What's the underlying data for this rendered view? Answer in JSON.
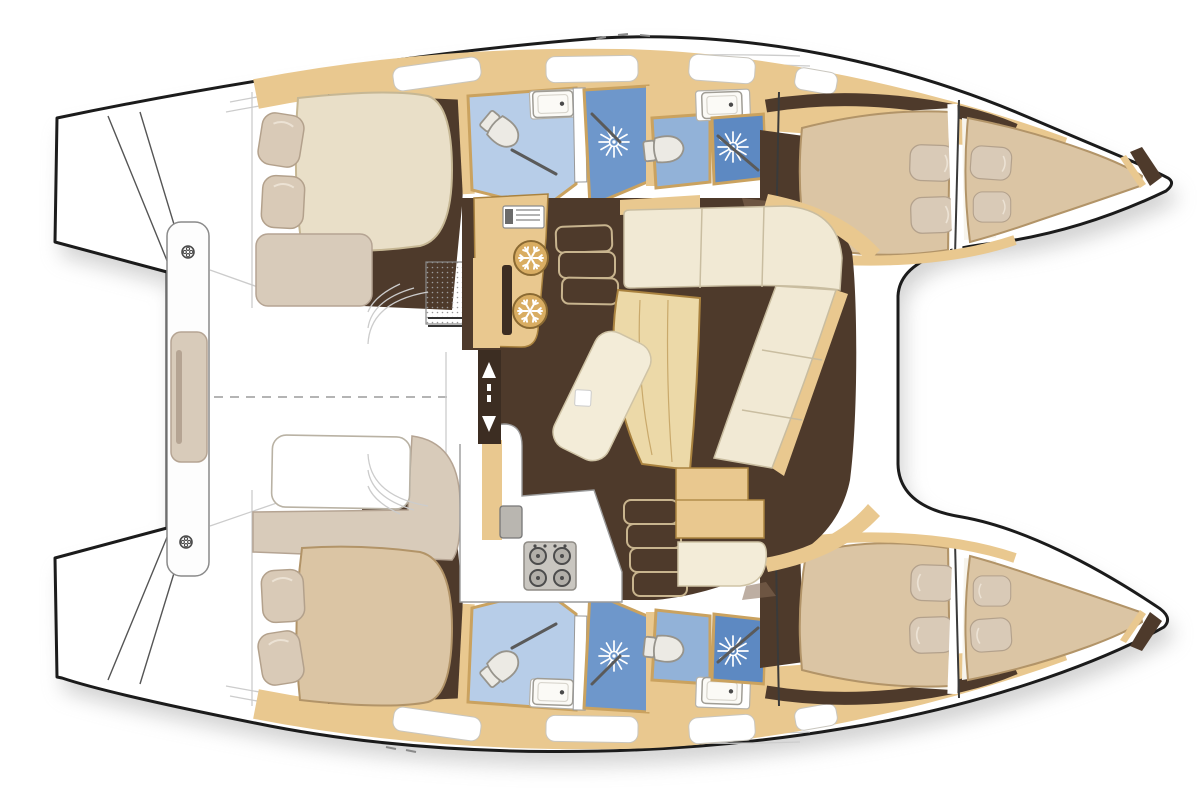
{
  "page": {
    "background": "#ffffff",
    "description": "Top-down interior layout floor plan of a sailing catamaran with four cabins, four heads, central salon and galley"
  },
  "palette": {
    "ink": "#1b1b1b",
    "hull_fill": "#ffffff",
    "white": "#ffffff",
    "shadow": "#a8a8a8",
    "wood": "#e9c88f",
    "wood_dark": "#a9823f",
    "wood_light": "#ecd9a8",
    "floor": "#4e3a2b",
    "floor_door": "#3c2d22",
    "entry_shadow": "#866b55",
    "bed_cream": "#e9dfc8",
    "bed_cream_edge": "#c6b794",
    "bed_tan": "#dbc5a4",
    "bed_tan_edge": "#b29468",
    "pillow": "#d9cab7",
    "pillow_edge": "#b3a18c",
    "greige": "#d8cbba",
    "greige_edge": "#b5a493",
    "cushion": "#f1e9d4",
    "cushion_edge": "#c9bda0",
    "tile_light": "#b7cde8",
    "tile_mid": "#92b2d8",
    "tile_dark": "#6e97cb",
    "tile_dark2": "#5d89c2",
    "tile_edge": "#caa25f",
    "fixture": "#eceae4",
    "fixture_edge": "#97948c",
    "steel": "#c9c6c0",
    "steel_dark": "#8f8c86",
    "burner": "#4c4c4c",
    "line_gray": "#9b9b9b",
    "line_light": "#cccccc"
  },
  "vessel": {
    "type": "catamaran",
    "view": "top-down interior floor plan",
    "bow_direction": "right",
    "hulls": [
      {
        "id": "port",
        "position": "top",
        "rooms": [
          {
            "name": "aft-cabin",
            "furniture": [
              "double-berth",
              "two-pillows",
              "bench-seat",
              "storage-grate"
            ]
          },
          {
            "name": "aft-head",
            "fixtures": [
              "toilet",
              "washbasin",
              "shower-stall"
            ]
          },
          {
            "name": "forward-head",
            "fixtures": [
              "toilet",
              "washbasin",
              "shower-stall"
            ]
          },
          {
            "name": "forward-cabin",
            "furniture": [
              "double-berth",
              "two-pillows"
            ]
          },
          {
            "name": "forepeak-berth",
            "furniture": [
              "berth",
              "pillows",
              "anchor-locker"
            ]
          }
        ]
      },
      {
        "id": "starboard",
        "position": "bottom",
        "rooms": [
          {
            "name": "aft-cabin",
            "furniture": [
              "double-berth",
              "two-pillows",
              "settee-wrap",
              "white-berth"
            ]
          },
          {
            "name": "aft-head",
            "fixtures": [
              "toilet",
              "washbasin",
              "shower-stall"
            ]
          },
          {
            "name": "forward-head",
            "fixtures": [
              "toilet",
              "washbasin",
              "shower-stall"
            ]
          },
          {
            "name": "forward-cabin",
            "furniture": [
              "double-berth",
              "two-pillows"
            ]
          },
          {
            "name": "forepeak-berth",
            "furniture": [
              "berth",
              "pillows",
              "anchor-locker"
            ]
          }
        ]
      }
    ],
    "bridgedeck": {
      "salon": [
        "l-shaped-settee",
        "dining-table",
        "chaise-seat",
        "nav-desk",
        "nav-seat",
        "mast-post"
      ],
      "galley": [
        "twin-top-loading-fridges",
        "oven-sink-unit",
        "four-burner-stove",
        "sink"
      ],
      "companionways": [
        "steps-to-port-hull",
        "steps-to-starboard-hull"
      ],
      "aft_door": "sliding-door-with-up-down-arrows"
    },
    "deck": [
      "port-transom-steps",
      "starboard-transom-steps",
      "aft-crossbeam-with-cleats",
      "open-cockpit",
      "dashed-centerline",
      "foredeck-between-bows"
    ]
  },
  "icons": {
    "shower": "white-starburst-rays-on-blue-tile",
    "refrigerator": "white-snowflake-in-circle",
    "stove": "four-burner-grid-with-knobs",
    "cleat": "small-scalloped-circle",
    "door_swing": "diagonal-line",
    "sliding_door": "white-up-and-down-arrows",
    "centerline": "gray-dashed-line"
  },
  "counts": {
    "cabins": 4,
    "heads": 4,
    "berths": 6,
    "showers": 4,
    "toilets": 4,
    "washbasins": 4,
    "fridges": 2,
    "stove_burners": 4,
    "cleats": 2,
    "hull_windows_per_side": 4
  }
}
